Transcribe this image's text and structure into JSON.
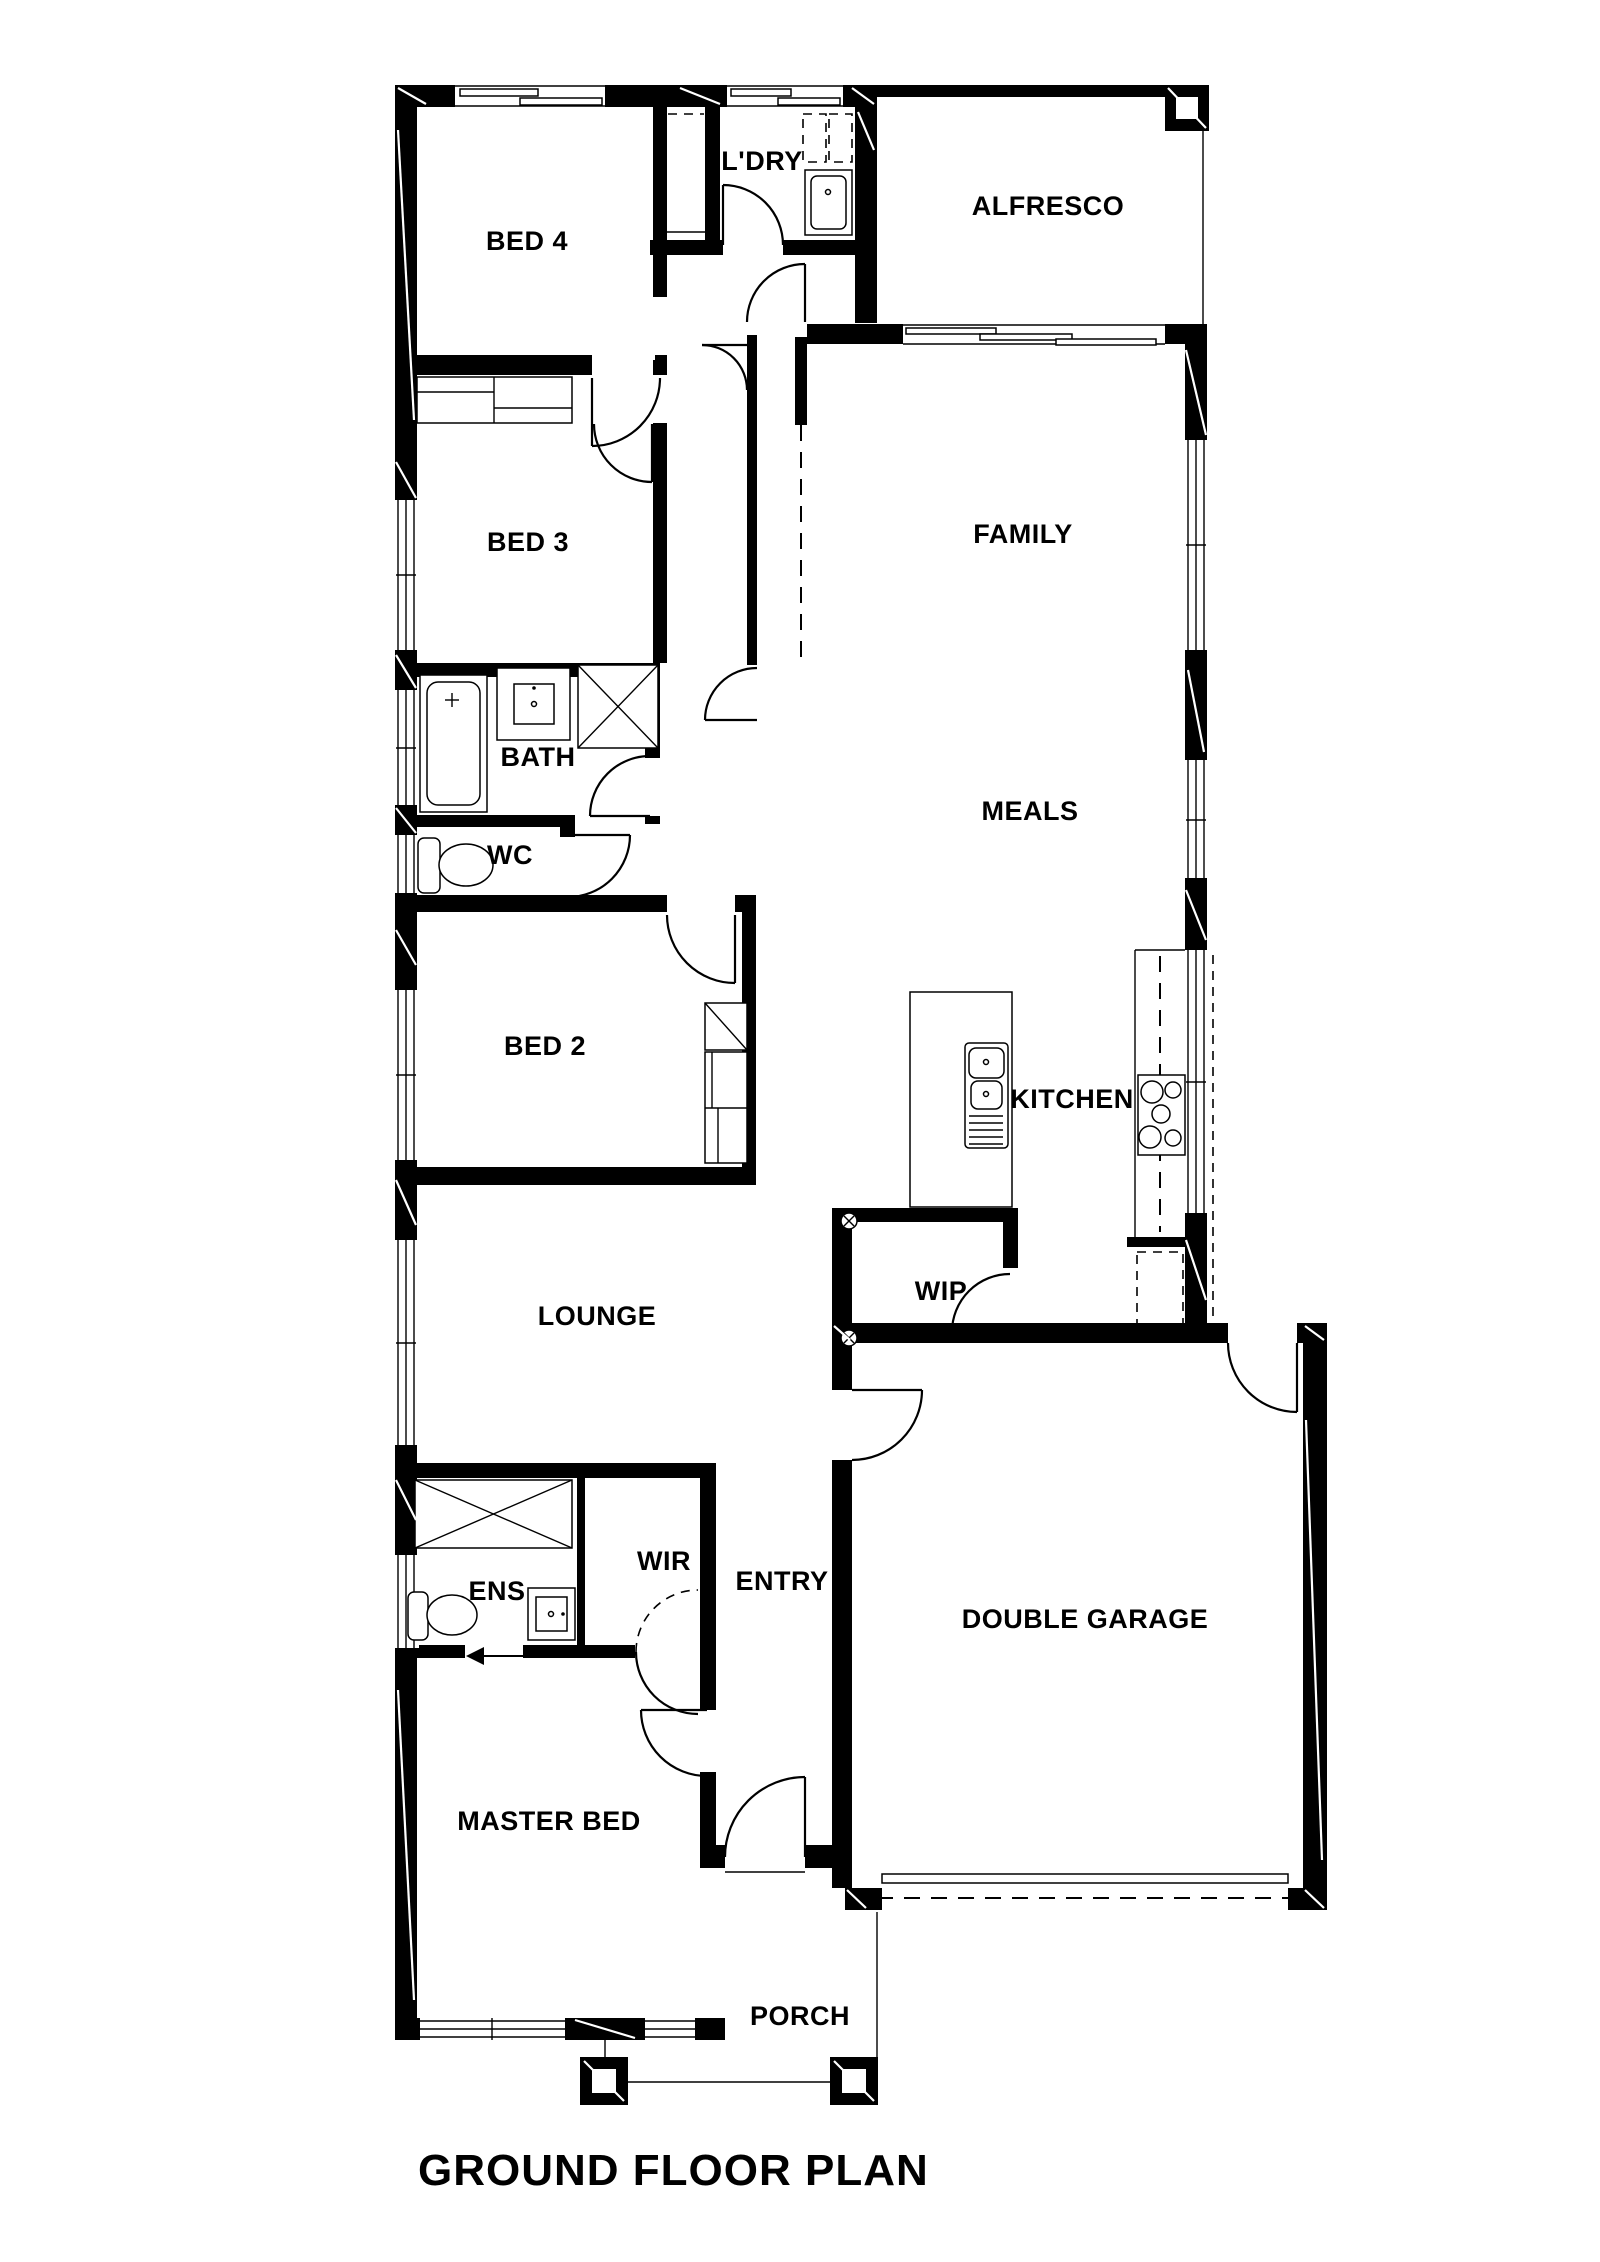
{
  "title": "GROUND FLOOR PLAN",
  "colors": {
    "wall": "#000000",
    "line": "#000000",
    "background": "#ffffff"
  },
  "rooms": {
    "bed4": {
      "label": "BED 4"
    },
    "ldry": {
      "label": "L'DRY"
    },
    "alfresco": {
      "label": "ALFRESCO"
    },
    "family": {
      "label": "FAMILY"
    },
    "meals": {
      "label": "MEALS"
    },
    "bed3": {
      "label": "BED 3"
    },
    "bath": {
      "label": "BATH"
    },
    "wc": {
      "label": "WC"
    },
    "bed2": {
      "label": "BED 2"
    },
    "kitchen": {
      "label": "KITCHEN"
    },
    "wip": {
      "label": "WIP"
    },
    "lounge": {
      "label": "LOUNGE"
    },
    "wir": {
      "label": "WIR"
    },
    "ens": {
      "label": "ENS"
    },
    "entry": {
      "label": "ENTRY"
    },
    "garage": {
      "label": "DOUBLE GARAGE"
    },
    "master": {
      "label": "MASTER BED"
    },
    "porch": {
      "label": "PORCH"
    }
  },
  "icons": [
    "bathtub-icon",
    "shower-icon",
    "toilet-icon",
    "vanity-basin-icon",
    "laundry-trough-icon",
    "overhead-cupboard-icon",
    "kitchen-island-icon",
    "double-sink-icon",
    "cooktop-icon",
    "fridge-space-icon",
    "wardrobe-icon",
    "linen-cupboard-icon",
    "sliding-stacker-door-icon",
    "hinged-door-icon",
    "window-icon",
    "column-icon",
    "garage-door-icon",
    "entry-arrow-icon",
    "service-point-icon",
    "bulkhead-dashed-line-icon"
  ]
}
